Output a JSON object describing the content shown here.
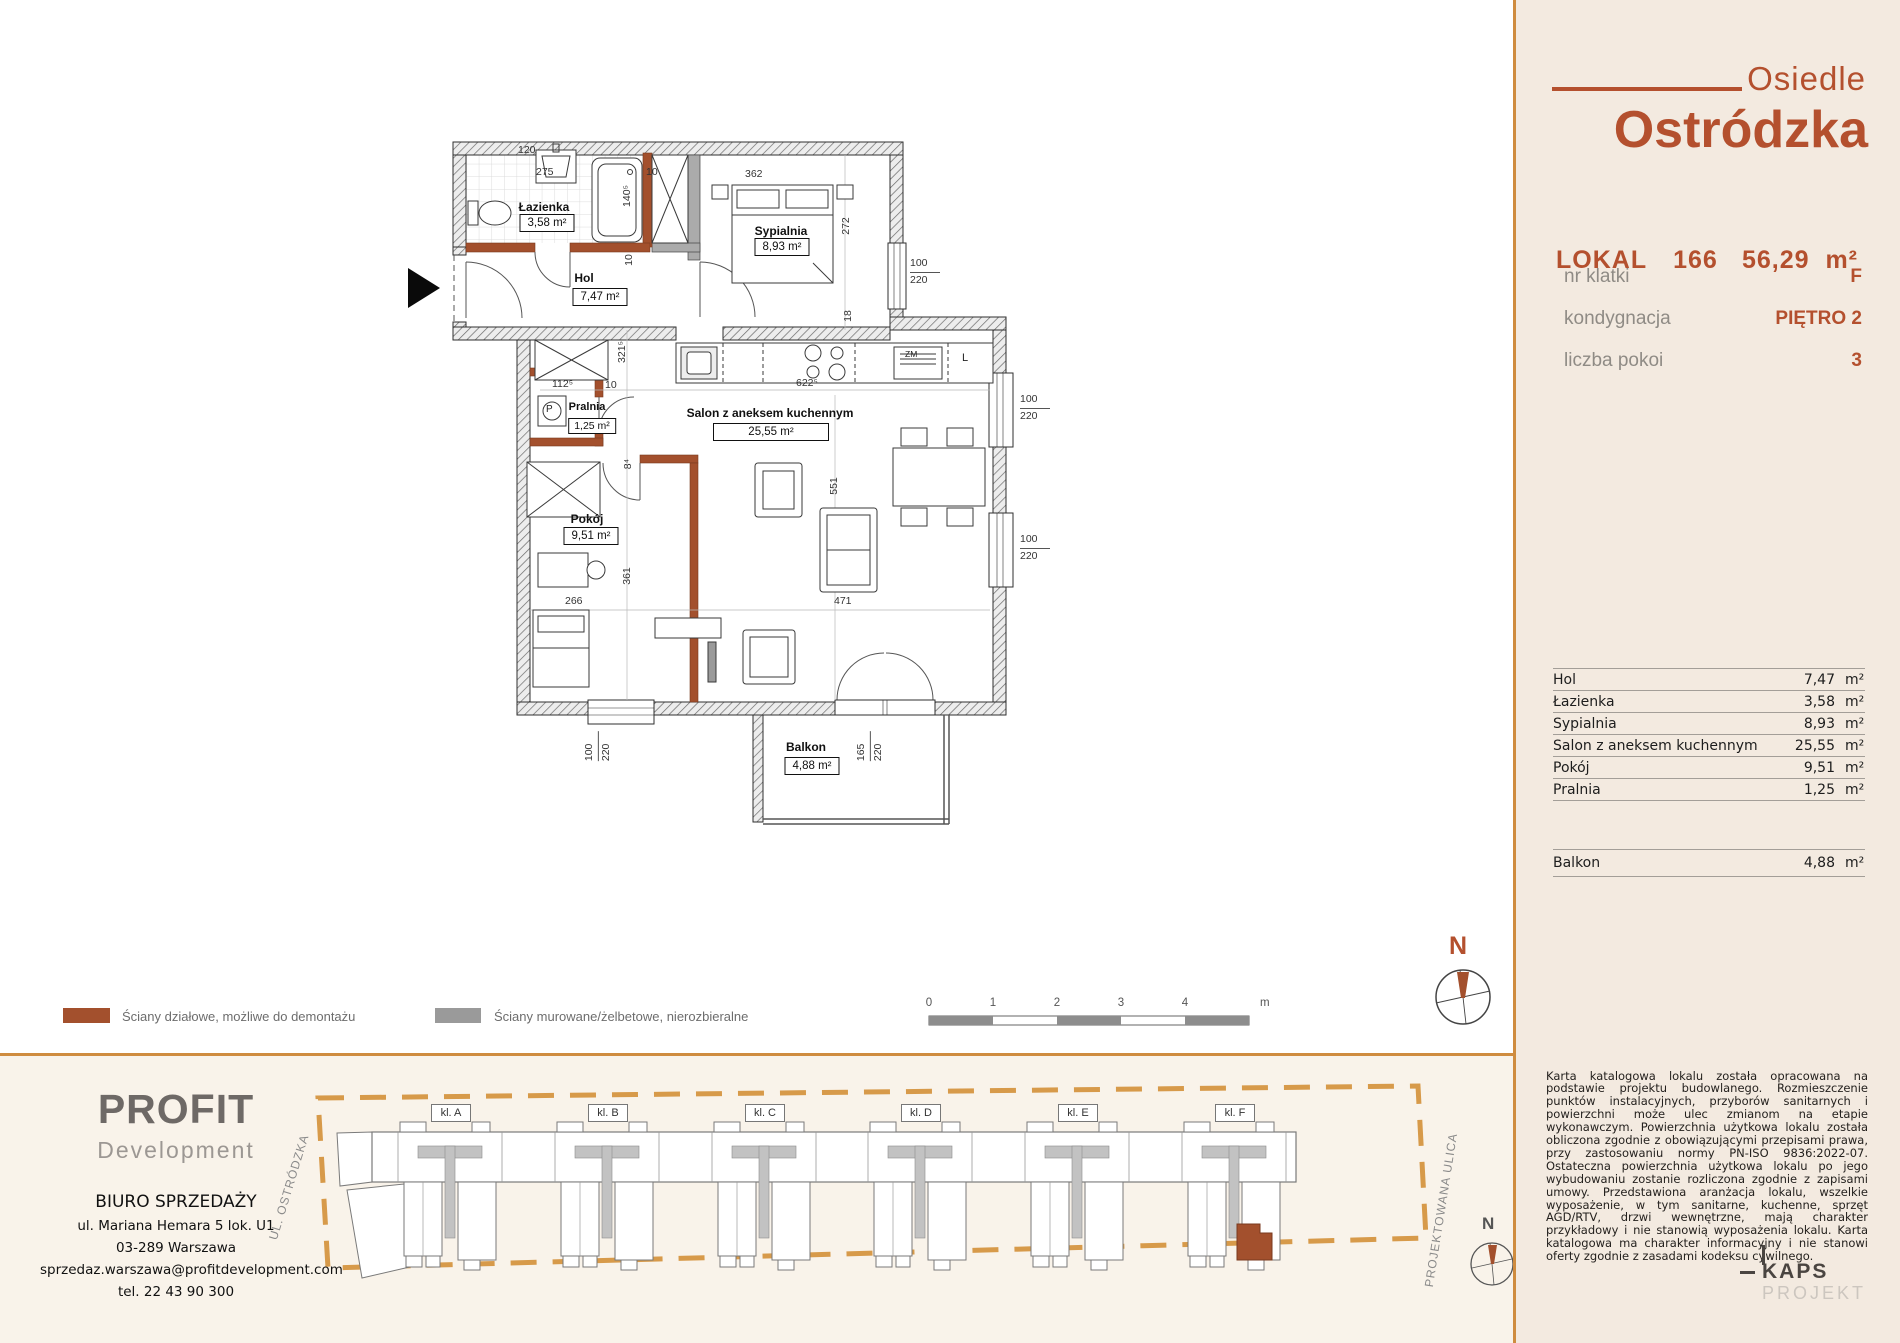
{
  "brand": {
    "prefix": "Osiedle",
    "name": "Ostródzka"
  },
  "unit": {
    "lokal_label": "LOKAL",
    "lokal_number": "166",
    "total_area": "56,29",
    "area_unit": "m²",
    "info": [
      {
        "label": "nr klatki",
        "value": "F"
      },
      {
        "label": "kondygnacja",
        "value": "PIĘTRO 2"
      },
      {
        "label": "liczba pokoi",
        "value": "3"
      }
    ]
  },
  "rooms": [
    {
      "name": "Hol",
      "area": "7,47",
      "unit": "m²"
    },
    {
      "name": "Łazienka",
      "area": "3,58",
      "unit": "m²"
    },
    {
      "name": "Sypialnia",
      "area": "8,93",
      "unit": "m²"
    },
    {
      "name": "Salon z aneksem kuchennym",
      "area": "25,55",
      "unit": "m²"
    },
    {
      "name": "Pokój",
      "area": "9,51",
      "unit": "m²"
    },
    {
      "name": "Pralnia",
      "area": "1,25",
      "unit": "m²"
    }
  ],
  "balcony": {
    "name": "Balkon",
    "area": "4,88",
    "unit": "m²"
  },
  "plan": {
    "dims": [
      "275",
      "120",
      "362",
      "140⁵",
      "272",
      "18",
      "10",
      "10",
      "321⁵",
      "112⁵",
      "10",
      "622⁵",
      "8⁴",
      "551",
      "361",
      "266",
      "471"
    ],
    "windows": [
      {
        "w": "100",
        "h": "220"
      },
      {
        "w": "100",
        "h": "220"
      },
      {
        "w": "100",
        "h": "220"
      },
      {
        "w": "100",
        "h": "220"
      },
      {
        "w": "165",
        "h": "220"
      }
    ],
    "appliances": {
      "washer": "P",
      "fridge": "L",
      "dishwasher": "ZM"
    }
  },
  "legend": [
    {
      "label": "Ściany działowe, możliwe do demontażu",
      "color": "#a3502d"
    },
    {
      "label": "Ściany murowane/żelbetowe, nierozbieralne",
      "color": "#9a9a9a"
    }
  ],
  "scalebar": {
    "ticks": [
      "0",
      "1",
      "2",
      "3",
      "4",
      "5"
    ],
    "unit": "m"
  },
  "compass": {
    "north": "N"
  },
  "siteplan": {
    "stairs": [
      "kl. A",
      "kl. B",
      "kl. C",
      "kl. D",
      "kl. E",
      "kl. F"
    ],
    "street_left": "UL. OSTRÓDZKA",
    "street_right": "PROJEKTOWANA ULICA"
  },
  "developer": {
    "name_top": "PROFIT",
    "name_bottom": "Development",
    "office": "BIURO SPRZEDAŻY",
    "address1": "ul. Mariana Hemara 5 lok. U1",
    "address2": "03-289 Warszawa",
    "email": "sprzedaz.warszawa@profitdevelopment.com",
    "phone": "tel. 22 43 90 300"
  },
  "kaps": {
    "name": "KAPS",
    "sub": "PROJEKT"
  },
  "disclaimer": "Karta katalogowa lokalu została opracowana na podstawie projektu budowlanego. Rozmieszczenie punktów instalacyjnych, przyborów sanitarnych i powierzchni może ulec zmianom na etapie wykonawczym. Powierzchnia użytkowa lokalu została obliczona zgodnie z obowiązującymi przepisami prawa, przy zastosowaniu normy PN-ISO 9836:2022-07. Ostateczna powierzchnia użytkowa lokalu po jego wybudowaniu zostanie rozliczona zgodnie z zapisami umowy. Przedstawiona aranżacja lokalu, wszelkie wyposażenie, w tym sanitarne, kuchenne, sprzęt AGD/RTV, drzwi wewnętrzne, mają charakter przykładowy i nie stanowią wyposażenia lokalu. Karta katalogowa ma charakter informacyjny i nie stanowi oferty zgodnie z zasadami kodeksu cywilnego.",
  "colors": {
    "accent": "#b4502e",
    "border": "#cf8c3f",
    "partition": "#a3502d",
    "structural": "#9a9a9a"
  }
}
